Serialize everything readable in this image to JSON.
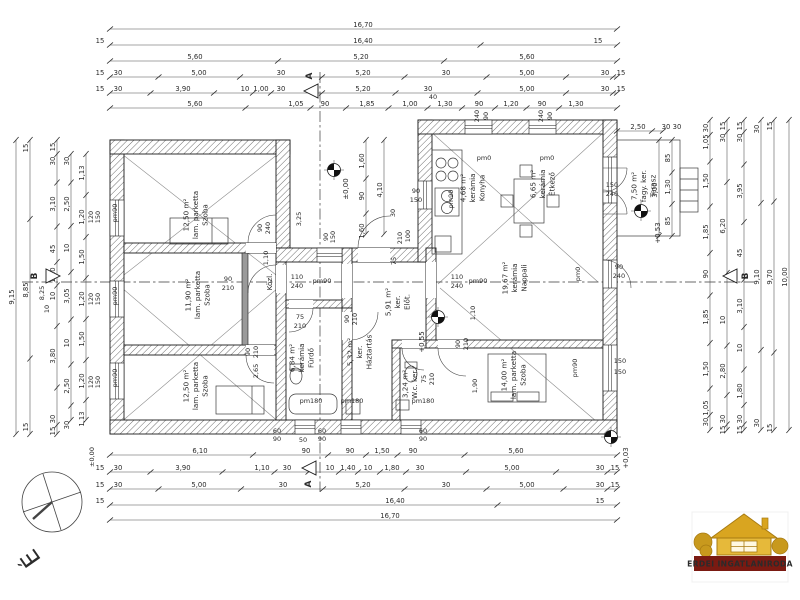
{
  "plan": {
    "compass_letter": "É",
    "logo_text": "ERDEI INGATLANIRODA",
    "rooms": [
      {
        "x": 198,
        "y": 215,
        "lines": [
          "Szoba",
          "lam. parketta",
          "12,50 m²"
        ]
      },
      {
        "x": 200,
        "y": 295,
        "lines": [
          "Szoba",
          "lam. parketta",
          "11,90 m²"
        ]
      },
      {
        "x": 198,
        "y": 386,
        "lines": [
          "Szoba",
          "lam. parketta",
          "12,50 m²"
        ]
      },
      {
        "x": 475,
        "y": 188,
        "lines": [
          "Konyha",
          "kerámia",
          "4,68 m²"
        ]
      },
      {
        "x": 545,
        "y": 184,
        "lines": [
          "Étkező",
          "kerámia",
          "6,65 m²"
        ]
      },
      {
        "x": 517,
        "y": 278,
        "lines": [
          "Nappali",
          "kerámia",
          "19,67 m²"
        ]
      },
      {
        "x": 516,
        "y": 375,
        "lines": [
          "Szoba",
          "lam. parketta",
          "14,00 m²"
        ]
      },
      {
        "x": 304,
        "y": 358,
        "lines": [
          "Fürdő",
          "kerámia",
          "6,84 m²"
        ]
      },
      {
        "x": 362,
        "y": 352,
        "lines": [
          "Háztartás",
          "ker.",
          "5,32 m²"
        ]
      },
      {
        "x": 400,
        "y": 302,
        "lines": [
          "Előt.",
          "ker.",
          "5,91 m²"
        ]
      },
      {
        "x": 412,
        "y": 384,
        "lines": [
          "W.c. ker.",
          "3,24 m²"
        ]
      },
      {
        "x": 272,
        "y": 282,
        "lines": [
          "Közl."
        ]
      },
      {
        "x": 646,
        "y": 186,
        "lines": [
          "Terasz",
          "fagy. ker.",
          "7,50 m²"
        ]
      }
    ],
    "dim_rows": [
      {
        "y": 29,
        "x1": 110,
        "x2": 617,
        "labels": [
          [
            363,
            "16,70"
          ]
        ]
      },
      {
        "y": 45,
        "x1": 110,
        "x2": 617,
        "labels": [
          [
            100,
            "15"
          ],
          [
            363,
            "16,40"
          ],
          [
            598,
            "15"
          ]
        ]
      },
      {
        "y": 61,
        "x1": 110,
        "x2": 617,
        "labels": [
          [
            195,
            "5,60"
          ],
          [
            361,
            "5,20"
          ],
          [
            527,
            "5,60"
          ]
        ]
      },
      {
        "y": 77,
        "x1": 110,
        "x2": 617,
        "labels": [
          [
            100,
            "15"
          ],
          [
            118,
            "30"
          ],
          [
            199,
            "5,00"
          ],
          [
            281,
            "30"
          ],
          [
            363,
            "5,20"
          ],
          [
            446,
            "30"
          ],
          [
            527,
            "5,00"
          ],
          [
            605,
            "30"
          ],
          [
            621,
            "15"
          ]
        ]
      },
      {
        "y": 93,
        "x1": 110,
        "x2": 617,
        "labels": [
          [
            100,
            "15"
          ],
          [
            118,
            "30"
          ],
          [
            183,
            "3,90"
          ],
          [
            245,
            "10"
          ],
          [
            261,
            "1,00"
          ],
          [
            281,
            "30"
          ],
          [
            363,
            "5,20"
          ],
          [
            428,
            "30"
          ],
          [
            527,
            "5,00"
          ],
          [
            605,
            "30"
          ],
          [
            621,
            "15"
          ]
        ]
      },
      {
        "y": 108,
        "x1": 110,
        "x2": 617,
        "labels": [
          [
            195,
            "5,60"
          ],
          [
            296,
            "1,05"
          ],
          [
            325,
            "90"
          ],
          [
            367,
            "1,85"
          ],
          [
            410,
            "1,00"
          ],
          [
            445,
            "1,30"
          ],
          [
            479,
            "90"
          ],
          [
            511,
            "1,20"
          ],
          [
            542,
            "90"
          ],
          [
            576,
            "1,30"
          ]
        ]
      },
      {
        "y": 131,
        "x1": 617,
        "x2": 663,
        "labels": [
          [
            638,
            "2,50"
          ],
          [
            666,
            "30"
          ],
          [
            677,
            "30"
          ]
        ]
      },
      {
        "y": 455,
        "x1": 110,
        "x2": 617,
        "labels": [
          [
            200,
            "6,10"
          ],
          [
            306,
            "90"
          ],
          [
            350,
            "90"
          ],
          [
            382,
            "1,50"
          ],
          [
            413,
            "90"
          ],
          [
            516,
            "5,60"
          ]
        ]
      },
      {
        "y": 472,
        "x1": 110,
        "x2": 617,
        "labels": [
          [
            100,
            "15"
          ],
          [
            118,
            "30"
          ],
          [
            183,
            "3,90"
          ],
          [
            262,
            "1,10"
          ],
          [
            287,
            "30"
          ],
          [
            330,
            "10"
          ],
          [
            348,
            "1,40"
          ],
          [
            368,
            "10"
          ],
          [
            392,
            "1,80"
          ],
          [
            420,
            "30"
          ],
          [
            512,
            "5,00"
          ],
          [
            600,
            "30"
          ],
          [
            615,
            "15"
          ]
        ]
      },
      {
        "y": 489,
        "x1": 110,
        "x2": 617,
        "labels": [
          [
            100,
            "15"
          ],
          [
            118,
            "30"
          ],
          [
            199,
            "5,00"
          ],
          [
            283,
            "30"
          ],
          [
            363,
            "5,20"
          ],
          [
            446,
            "30"
          ],
          [
            527,
            "5,00"
          ],
          [
            600,
            "30"
          ],
          [
            615,
            "15"
          ]
        ]
      },
      {
        "y": 505,
        "x1": 110,
        "x2": 617,
        "labels": [
          [
            100,
            "15"
          ],
          [
            395,
            "16,40"
          ],
          [
            600,
            "15"
          ]
        ]
      },
      {
        "y": 520,
        "x1": 110,
        "x2": 617,
        "labels": [
          [
            390,
            "16,70"
          ]
        ]
      }
    ],
    "dim_cols": [
      {
        "x": 16,
        "y1": 140,
        "y2": 434,
        "labels": [
          [
            297,
            "9,15"
          ]
        ]
      },
      {
        "x": 30,
        "y1": 140,
        "y2": 434,
        "labels": [
          [
            148,
            "15"
          ],
          [
            290,
            "8,85"
          ],
          [
            427,
            "15"
          ]
        ]
      },
      {
        "x": 57,
        "y1": 140,
        "y2": 434,
        "labels": [
          [
            147,
            "15"
          ],
          [
            161,
            "30"
          ],
          [
            204,
            "3,10"
          ],
          [
            249,
            "45"
          ],
          [
            275,
            "1,10"
          ],
          [
            296,
            "10"
          ],
          [
            356,
            "3,80"
          ],
          [
            419,
            "30"
          ],
          [
            431,
            "15"
          ]
        ]
      },
      {
        "x": 71,
        "y1": 154,
        "y2": 420,
        "labels": [
          [
            161,
            "30"
          ],
          [
            204,
            "2,50"
          ],
          [
            248,
            "10"
          ],
          [
            296,
            "3,05"
          ],
          [
            343,
            "10"
          ],
          [
            386,
            "2,50"
          ],
          [
            425,
            "30"
          ]
        ]
      },
      {
        "x": 86,
        "y1": 154,
        "y2": 420,
        "labels": [
          [
            173,
            "1,13"
          ],
          [
            217,
            "1,20"
          ],
          [
            257,
            "1,50"
          ],
          [
            299,
            "1,20"
          ],
          [
            339,
            "1,50"
          ],
          [
            381,
            "1,20"
          ],
          [
            419,
            "1,13"
          ]
        ]
      },
      {
        "x": 366,
        "y1": 140,
        "y2": 234,
        "labels": [
          [
            161,
            "1,60"
          ],
          [
            196,
            "90"
          ],
          [
            231,
            "1,60"
          ]
        ]
      },
      {
        "x": 384,
        "y1": 140,
        "y2": 234,
        "labels": [
          [
            190,
            "4,10"
          ]
        ]
      },
      {
        "x": 659,
        "y1": 140,
        "y2": 236,
        "labels": [
          [
            190,
            "3,00"
          ]
        ]
      },
      {
        "x": 672,
        "y1": 140,
        "y2": 236,
        "labels": [
          [
            158,
            "85"
          ],
          [
            187,
            "1,30"
          ],
          [
            221,
            "85"
          ]
        ]
      },
      {
        "x": 710,
        "y1": 120,
        "y2": 430,
        "labels": [
          [
            128,
            "30"
          ],
          [
            142,
            "1,05"
          ],
          [
            181,
            "1,50"
          ],
          [
            232,
            "1,85"
          ],
          [
            274,
            "90"
          ],
          [
            317,
            "1,85"
          ],
          [
            369,
            "1,50"
          ],
          [
            408,
            "1,05"
          ],
          [
            422,
            "30"
          ]
        ]
      },
      {
        "x": 727,
        "y1": 120,
        "y2": 430,
        "labels": [
          [
            126,
            "15"
          ],
          [
            138,
            "30"
          ],
          [
            226,
            "6,20"
          ],
          [
            320,
            "10"
          ],
          [
            371,
            "2,80"
          ],
          [
            419,
            "30"
          ],
          [
            430,
            "15"
          ]
        ]
      },
      {
        "x": 744,
        "y1": 120,
        "y2": 430,
        "labels": [
          [
            126,
            "15"
          ],
          [
            138,
            "30"
          ],
          [
            191,
            "3,95"
          ],
          [
            253,
            "45"
          ],
          [
            306,
            "3,10"
          ],
          [
            348,
            "10"
          ],
          [
            391,
            "1,80"
          ],
          [
            419,
            "30"
          ],
          [
            430,
            "15"
          ]
        ]
      },
      {
        "x": 761,
        "y1": 120,
        "y2": 430,
        "labels": [
          [
            129,
            "30"
          ],
          [
            277,
            "9,10"
          ],
          [
            423,
            "30"
          ]
        ]
      },
      {
        "x": 774,
        "y1": 120,
        "y2": 430,
        "labels": [
          [
            126,
            "15"
          ],
          [
            277,
            "9,70"
          ],
          [
            428,
            "15"
          ]
        ]
      },
      {
        "x": 789,
        "y1": 120,
        "y2": 430,
        "labels": [
          [
            277,
            "10,00"
          ]
        ]
      }
    ],
    "free_labels": [
      [
        433,
        99,
        "40",
        "h"
      ],
      [
        301,
        219,
        "3,25",
        "v"
      ],
      [
        543,
        116,
        "240",
        "v"
      ],
      [
        552,
        116,
        "90",
        "v"
      ],
      [
        479,
        116,
        "240",
        "v"
      ],
      [
        488,
        116,
        "90",
        "v"
      ],
      [
        484,
        160,
        "pm0",
        "h"
      ],
      [
        547,
        160,
        "pm0",
        "h"
      ],
      [
        416,
        193,
        "90",
        "h"
      ],
      [
        416,
        202,
        "150",
        "h"
      ],
      [
        453,
        199,
        "pm90",
        "v"
      ],
      [
        395,
        213,
        "30",
        "v"
      ],
      [
        402,
        238,
        "210",
        "v"
      ],
      [
        410,
        236,
        "100",
        "v"
      ],
      [
        396,
        261,
        "75",
        "v"
      ],
      [
        328,
        237,
        "90",
        "v"
      ],
      [
        335,
        237,
        "150",
        "v"
      ],
      [
        262,
        228,
        "90",
        "v"
      ],
      [
        270,
        228,
        "240",
        "v"
      ],
      [
        297,
        279,
        "110",
        "h"
      ],
      [
        297,
        288,
        "240",
        "h"
      ],
      [
        322,
        283,
        "pm90",
        "h"
      ],
      [
        457,
        279,
        "110",
        "h"
      ],
      [
        457,
        288,
        "240",
        "h"
      ],
      [
        478,
        283,
        "pm90",
        "h"
      ],
      [
        268,
        258,
        "1,10",
        "v"
      ],
      [
        228,
        281,
        "90",
        "h"
      ],
      [
        228,
        290,
        "210",
        "h"
      ],
      [
        117,
        213,
        "pm90",
        "v"
      ],
      [
        117,
        296,
        "pm90",
        "v"
      ],
      [
        117,
        378,
        "pm90",
        "v"
      ],
      [
        93,
        217,
        "120",
        "v"
      ],
      [
        100,
        217,
        "150",
        "v"
      ],
      [
        93,
        299,
        "120",
        "v"
      ],
      [
        100,
        299,
        "150",
        "v"
      ],
      [
        93,
        382,
        "120",
        "v"
      ],
      [
        100,
        382,
        "150",
        "v"
      ],
      [
        44,
        293,
        "8,25",
        "v"
      ],
      [
        49,
        309,
        "10",
        "v"
      ],
      [
        300,
        319,
        "75",
        "h"
      ],
      [
        300,
        328,
        "210",
        "h"
      ],
      [
        258,
        371,
        "2,65",
        "v"
      ],
      [
        250,
        352,
        "90",
        "v"
      ],
      [
        258,
        352,
        "210",
        "v"
      ],
      [
        349,
        319,
        "90",
        "v"
      ],
      [
        357,
        319,
        "210",
        "v"
      ],
      [
        426,
        379,
        "75",
        "v"
      ],
      [
        434,
        379,
        "210",
        "v"
      ],
      [
        460,
        344,
        "90",
        "v"
      ],
      [
        468,
        344,
        "210",
        "v"
      ],
      [
        477,
        386,
        "1,90",
        "v"
      ],
      [
        475,
        313,
        "1,10",
        "v"
      ],
      [
        612,
        187,
        "150",
        "h"
      ],
      [
        612,
        196,
        "240",
        "h"
      ],
      [
        580,
        274,
        "pm0",
        "v"
      ],
      [
        619,
        269,
        "90",
        "h"
      ],
      [
        619,
        278,
        "240",
        "h"
      ],
      [
        577,
        368,
        "pm90",
        "v"
      ],
      [
        620,
        363,
        "150",
        "h"
      ],
      [
        620,
        374,
        "150",
        "h"
      ],
      [
        311,
        403,
        "pm180",
        "h"
      ],
      [
        352,
        403,
        "pm180",
        "h"
      ],
      [
        423,
        403,
        "pm180",
        "h"
      ],
      [
        277,
        433,
        "60",
        "h"
      ],
      [
        277,
        441,
        "90",
        "h"
      ],
      [
        303,
        442,
        "50",
        "h"
      ],
      [
        322,
        433,
        "60",
        "h"
      ],
      [
        322,
        441,
        "90",
        "h"
      ],
      [
        423,
        433,
        "60",
        "h"
      ],
      [
        423,
        441,
        "90",
        "h"
      ],
      [
        94,
        457,
        "±0,00",
        "v"
      ]
    ],
    "levels": [
      {
        "cx": 334,
        "cy": 170,
        "tx": 348,
        "ty": 189,
        "text": "±0,00"
      },
      {
        "cx": 438,
        "cy": 317,
        "tx": 424,
        "ty": 342,
        "text": "+0,55"
      },
      {
        "cx": 641,
        "cy": 211,
        "tx": 660,
        "ty": 233,
        "text": "+0,53"
      },
      {
        "cx": 611,
        "cy": 437,
        "tx": 628,
        "ty": 458,
        "text": "+0,03"
      }
    ],
    "sections": [
      {
        "letter": "A",
        "tx": 312,
        "ty": 76
      },
      {
        "letter": "A",
        "tx": 311,
        "ty": 484
      },
      {
        "letter": "B",
        "tx": 37,
        "ty": 276
      },
      {
        "letter": "B",
        "tx": 748,
        "ty": 276
      }
    ]
  }
}
